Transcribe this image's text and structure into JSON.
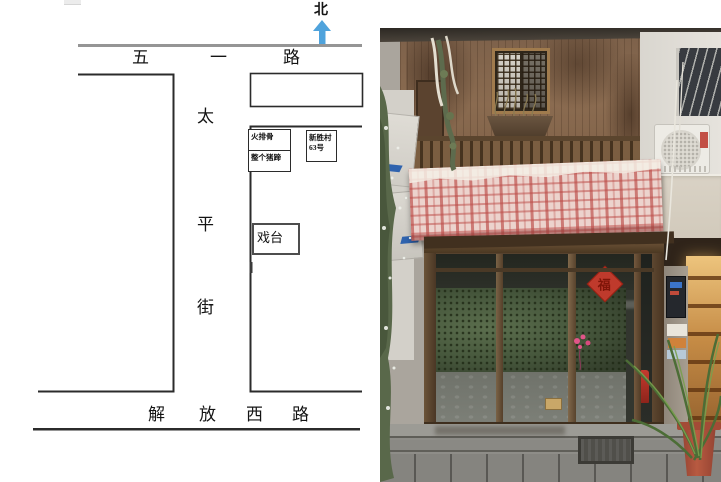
{
  "map": {
    "north_label": "北",
    "top_road_chars": [
      "五",
      "一",
      "路"
    ],
    "vertical_street_chars": [
      "太",
      "平",
      "街"
    ],
    "bottom_road_chars": [
      "解",
      "放",
      "西",
      "路"
    ],
    "labels": {
      "stall_top": "火排骨",
      "stall_bottom": "整个猪蹄",
      "address_line1": "新胜村",
      "address_line2": "63号",
      "stage": "戏台"
    },
    "colors": {
      "north_arrow": "#4fa3dc",
      "top_road_line": "#959595",
      "ink": "#2b2b2b"
    }
  },
  "photo": {
    "door_sign_char": "福",
    "colors": {
      "awning_base": "#ecd3cd",
      "awning_stripe": "#bb4a46",
      "wood_facade": "#85664c",
      "storefront_frame": "#5a4733",
      "glass_foliage": "#46573c",
      "shop_glow": "#e0ac5f",
      "plant_pot": "#a8503a",
      "ground": "#8b8a85"
    }
  }
}
